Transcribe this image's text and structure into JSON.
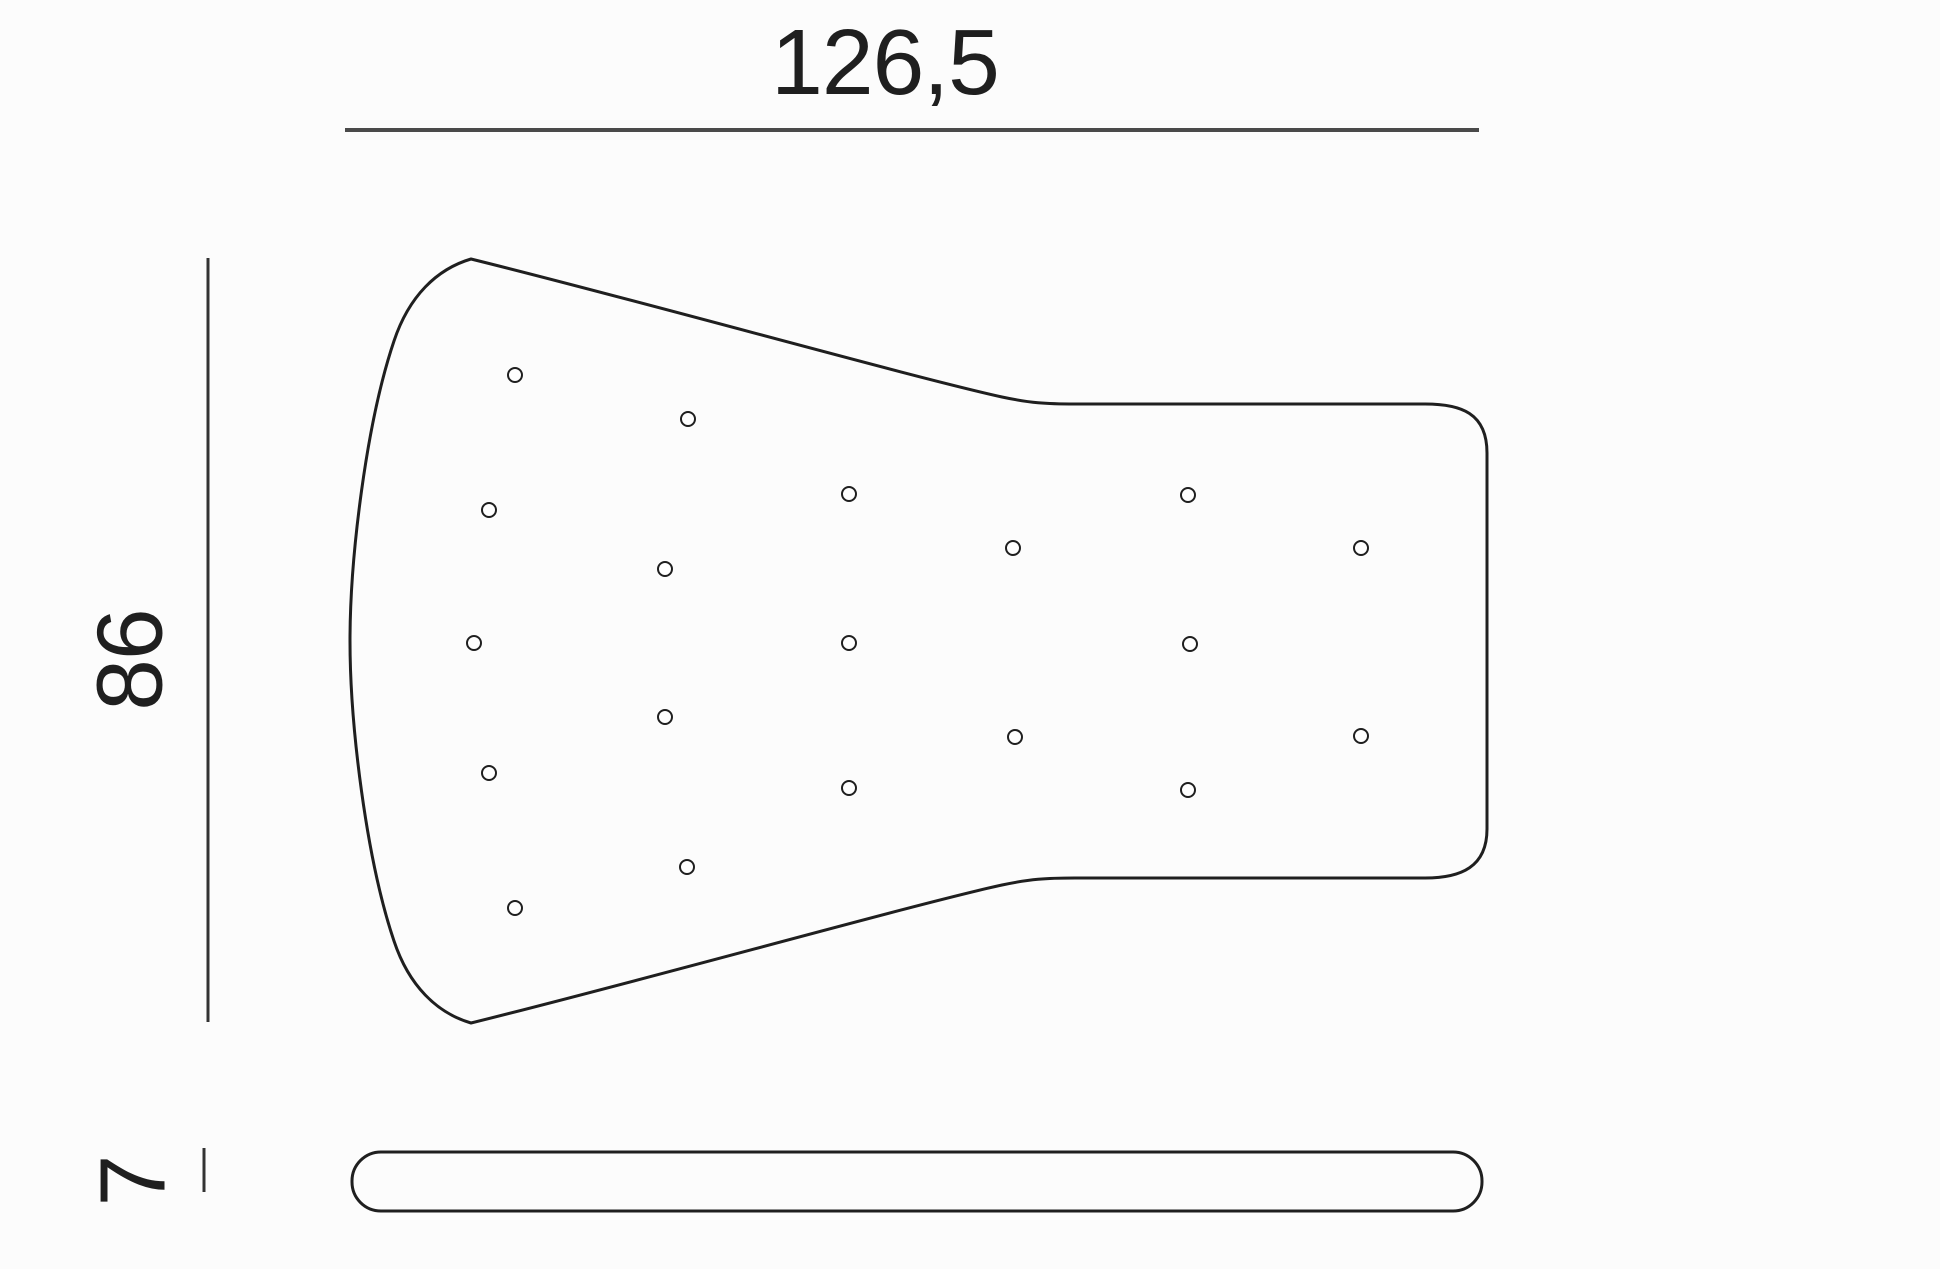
{
  "dimensions": {
    "width": {
      "label": "126,5"
    },
    "height": {
      "label": "86"
    },
    "thickness": {
      "label": "7"
    }
  },
  "colors": {
    "background": "#fcfcfc",
    "outline": "#1f1f1f",
    "dimension_line": "#4a4a4a",
    "dimension_tick": "#333333",
    "text": "#1f1f1f",
    "hole_fill": "#ffffff"
  },
  "top_view": {
    "hole_radius": 7,
    "hole_stroke_width": 2,
    "holes": [
      {
        "x": 515,
        "y": 375
      },
      {
        "x": 688,
        "y": 419
      },
      {
        "x": 489,
        "y": 510
      },
      {
        "x": 849,
        "y": 494
      },
      {
        "x": 1188,
        "y": 495
      },
      {
        "x": 665,
        "y": 569
      },
      {
        "x": 1013,
        "y": 548
      },
      {
        "x": 1361,
        "y": 548
      },
      {
        "x": 474,
        "y": 643
      },
      {
        "x": 849,
        "y": 643
      },
      {
        "x": 1190,
        "y": 644
      },
      {
        "x": 665,
        "y": 717
      },
      {
        "x": 1015,
        "y": 737
      },
      {
        "x": 1361,
        "y": 736
      },
      {
        "x": 489,
        "y": 773
      },
      {
        "x": 849,
        "y": 788
      },
      {
        "x": 1188,
        "y": 790
      },
      {
        "x": 687,
        "y": 867
      },
      {
        "x": 515,
        "y": 908
      }
    ]
  }
}
